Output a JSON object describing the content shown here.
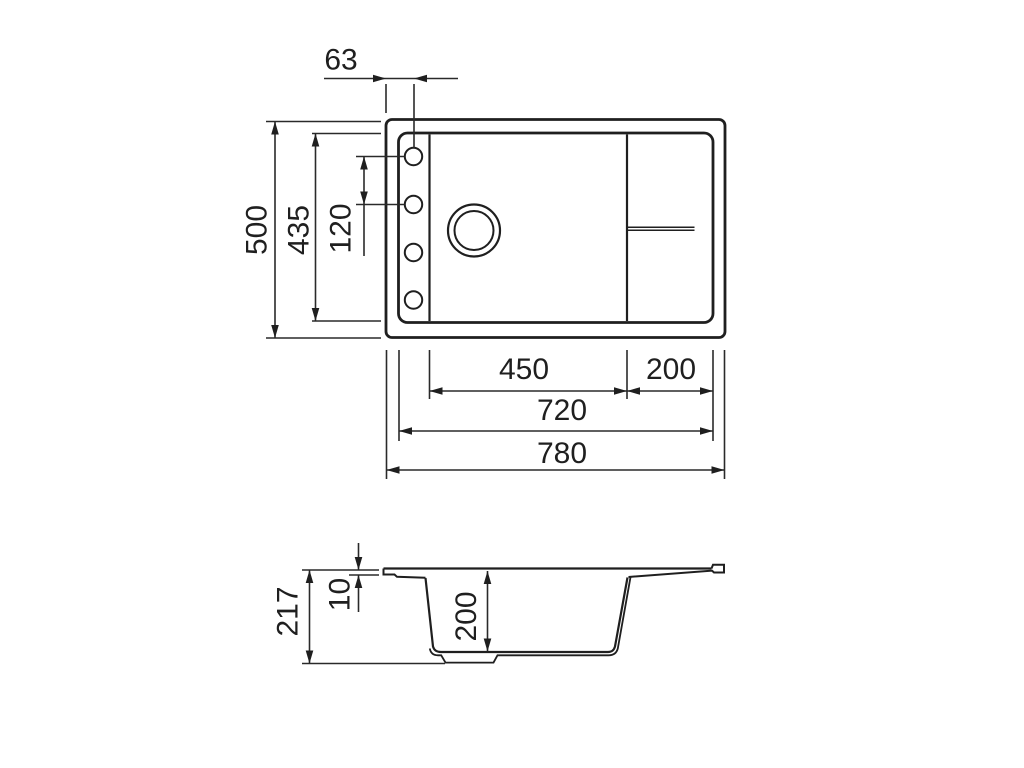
{
  "diagram": {
    "type": "technical-drawing",
    "subject": "kitchen sink with drainboard - dimensioned top view and cross-section",
    "units": "mm",
    "colors": {
      "line": "#1f1f1f",
      "background": "#ffffff"
    },
    "top_view": {
      "features": {
        "tap_holes": 4,
        "drain_circles": 2,
        "bowl_divider_lines": 1,
        "overflow_double_line": 1
      },
      "dims": {
        "hole_offset": "63",
        "outer_height": "500",
        "inner_height": "435",
        "hole_pitch": "120",
        "bowl_width": "450",
        "drainboard_width": "200",
        "inner_width": "720",
        "outer_width": "780"
      }
    },
    "side_view": {
      "dims": {
        "total_height": "217",
        "rim_thickness": "10",
        "bowl_depth": "200"
      }
    }
  }
}
